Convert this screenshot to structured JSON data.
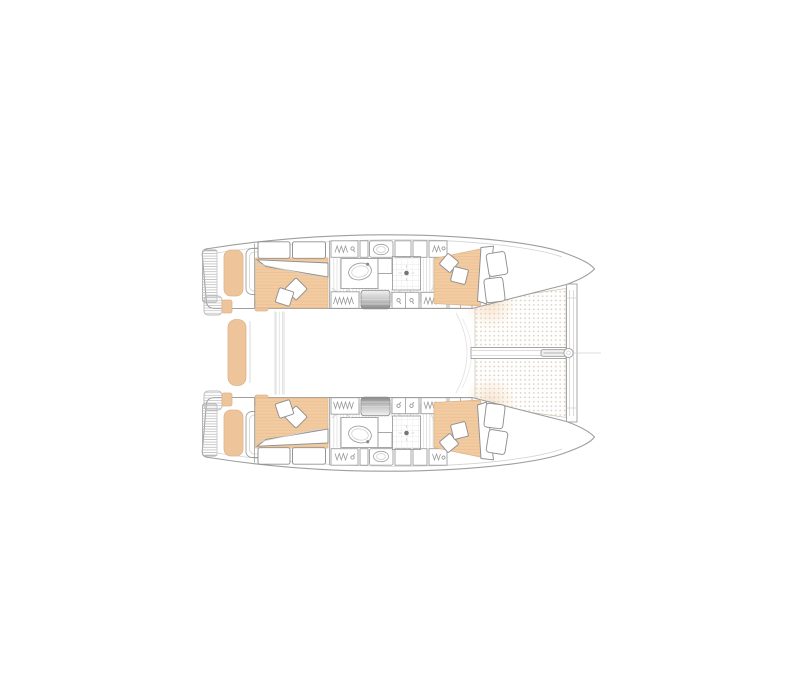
{
  "page": {
    "background": "#ffffff"
  },
  "colors": {
    "line": "#9e9e9e",
    "linefaint": "#d2d2d2",
    "peach": "#f3cba1",
    "peachstripe": "#e8ba8e",
    "peachedge": "#dcb58c",
    "bench": "#eec49b",
    "meshdot": "#d9cdb6",
    "hatch": "#d9d9d9",
    "platformhatch": "#bdbdbd",
    "stepsdark": "#8a8a8a",
    "white": "#ffffff"
  },
  "boat": {
    "type": "catamaran",
    "view": "overhead interior floor plan, bow pointing right",
    "symmetry": "port (top) and starboard (bottom) hulls are mirrored",
    "hull_elements": [
      "swim-platform",
      "transom-step",
      "cockpit-bench",
      "helm-seat",
      "aft-cabin-double-berth",
      "head-pillows",
      "throw-pillows",
      "duvet-fold",
      "wardrobe-hanging-locker",
      "head-compartment",
      "sink",
      "toilet",
      "shower-with-drain",
      "companionway-steps",
      "cabinet-doors",
      "forward-cabin-double-berth",
      "forward-berth-cushions"
    ],
    "shared_elements": [
      "cockpit-center-bench",
      "cockpit-sliding-door",
      "saloon",
      "trampoline-net-upper",
      "trampoline-net-lower",
      "bow-crossbeam",
      "center-longitudinal-beam",
      "bowsprit-roller",
      "forestay-fitting",
      "forestay-line",
      "port-bow-tip",
      "starboard-bow-tip"
    ],
    "counts": {
      "cabins": 4,
      "heads": 2,
      "trampoline_panels": 2,
      "hulls": 2
    }
  }
}
